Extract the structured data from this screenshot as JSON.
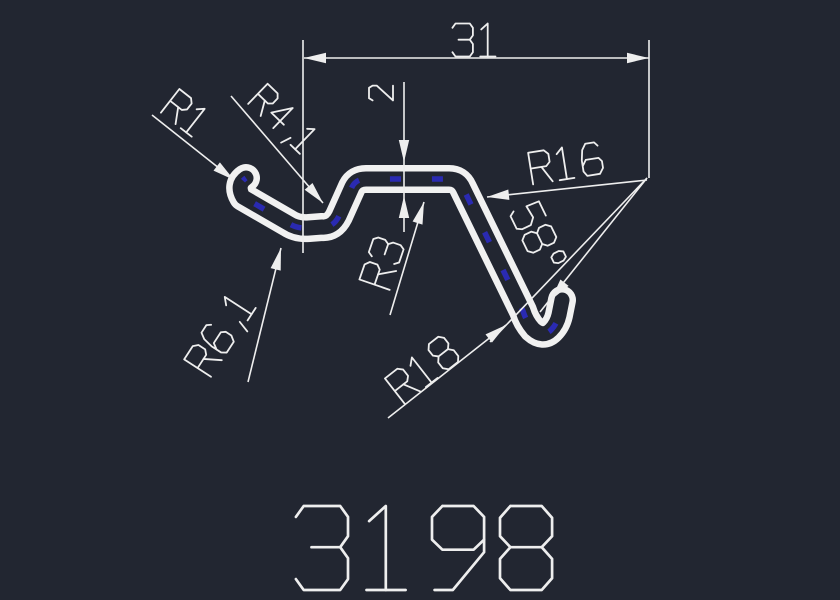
{
  "canvas": {
    "background": "#222631",
    "line_color": "#eeeeee",
    "profile_color": "#f1f1f1",
    "accent_blue": "#2a2ab2"
  },
  "drawing": {
    "type": "profile-cross-section",
    "labels": {
      "width": "31",
      "thickness": "2",
      "radius_tip": "R1",
      "radius_inner_hook": "R4,1",
      "radius_top_inner": "R3",
      "radius_outer_hook": "R6,1",
      "radius_leg": "R18",
      "radius_top_outer": "R16",
      "bend_angle": "58°",
      "part_number": "3198"
    }
  }
}
